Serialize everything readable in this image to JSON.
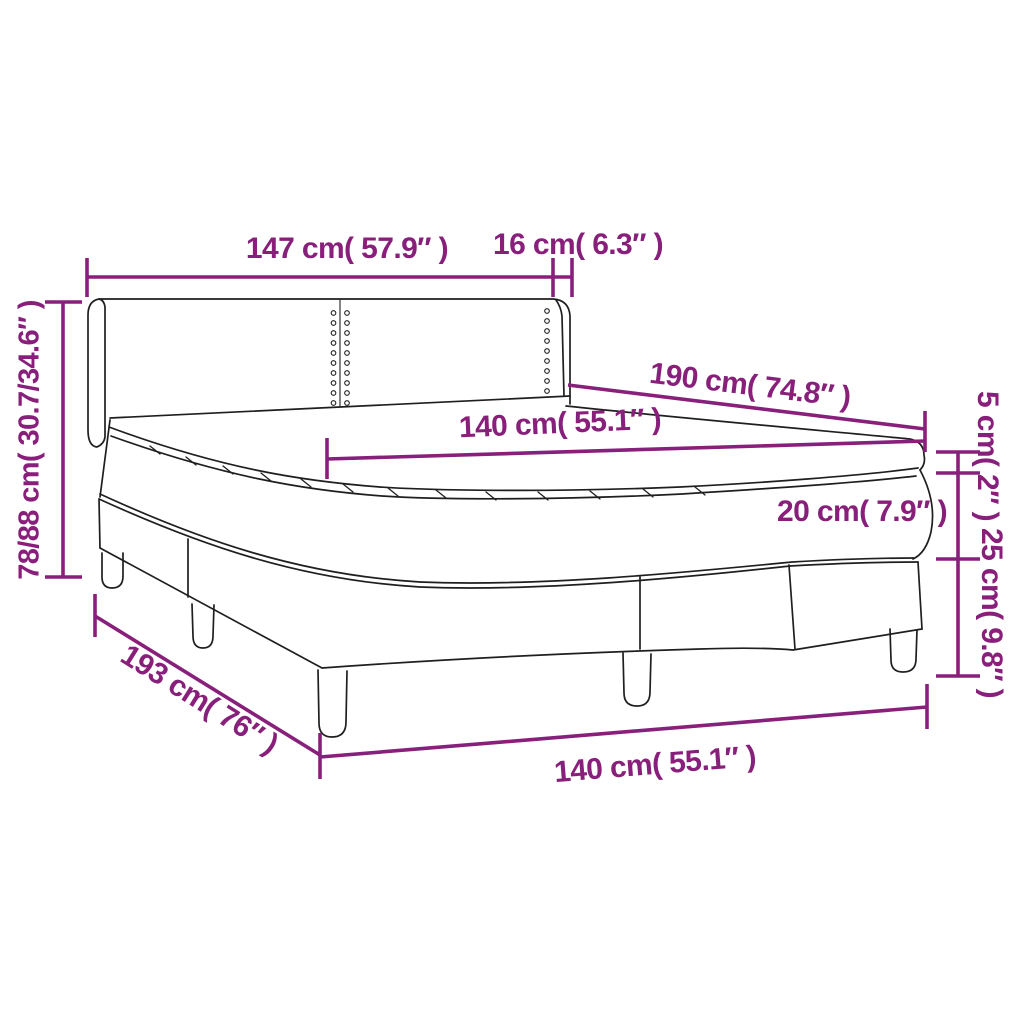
{
  "diagram_type": "product-dimension-diagram",
  "colors": {
    "dimension_annotation": "#881F7B",
    "line_art": "#1F1F1F",
    "background": "#FFFFFF"
  },
  "dimensions": {
    "headboard_width": "147 cm( 57.9″ )",
    "headboard_side_depth": "16 cm( 6.3″ )",
    "bed_length": "190 cm( 74.8″ )",
    "mattress_width_top": "140 cm( 55.1″ )",
    "topper_height": "5 cm( 2″ )",
    "mattress_height": "20 cm( 7.9″ )",
    "base_height": "25 cm( 9.8″ )",
    "headboard_height": "78/88 cm( 30.7/34.6″ )",
    "base_length": "193 cm( 76″ )",
    "mattress_width_bottom": "140 cm( 55.1″ )"
  }
}
